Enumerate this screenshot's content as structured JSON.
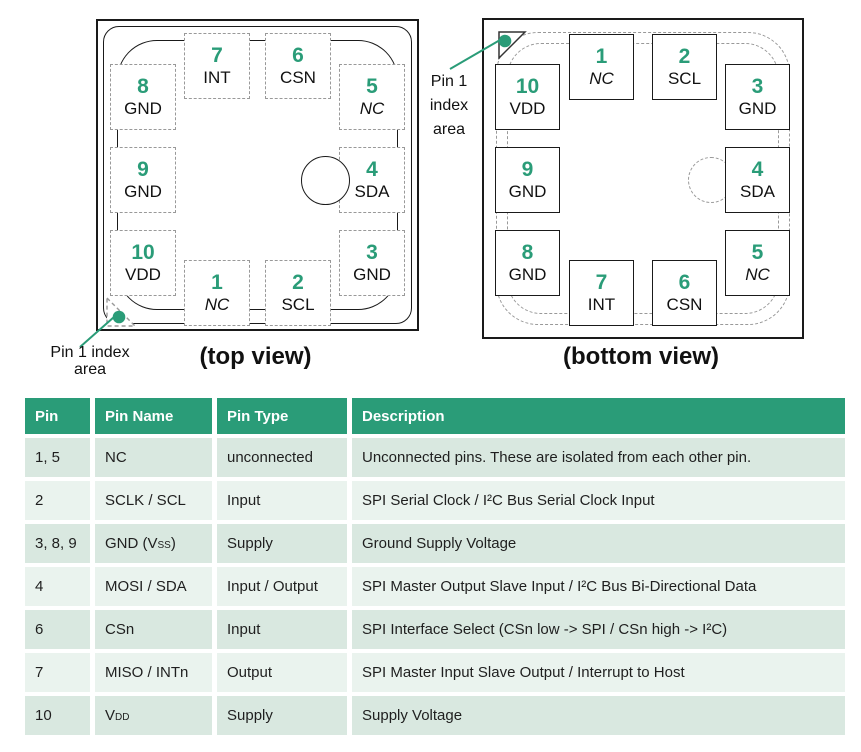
{
  "accent_green": "#2a9c78",
  "diagram": {
    "pins": [
      {
        "num": "1",
        "label": "NC"
      },
      {
        "num": "2",
        "label": "SCL"
      },
      {
        "num": "3",
        "label": "GND"
      },
      {
        "num": "4",
        "label": "SDA"
      },
      {
        "num": "5",
        "label": "NC"
      },
      {
        "num": "6",
        "label": "CSN"
      },
      {
        "num": "7",
        "label": "INT"
      },
      {
        "num": "8",
        "label": "GND"
      },
      {
        "num": "9",
        "label": "GND"
      },
      {
        "num": "10",
        "label": "VDD"
      }
    ],
    "top_view": {
      "caption": "(top view)",
      "index_lines": [
        "Pin 1 index",
        "area"
      ]
    },
    "bottom_view": {
      "caption": "(bottom view)",
      "index_lines": [
        "Pin 1",
        "index",
        "area"
      ]
    }
  },
  "table": {
    "header_bg": "#2a9c78",
    "row_color_dark": "#d9e8e0",
    "row_color_light": "#eaf3ee",
    "headers": [
      "Pin",
      "Pin Name",
      "Pin Type",
      "Description"
    ],
    "rows": [
      {
        "pin": "1, 5",
        "name": {
          "pre": "NC",
          "sub": "",
          "post": ""
        },
        "type": "unconnected",
        "desc": "Unconnected pins. These are isolated from each other pin."
      },
      {
        "pin": "2",
        "name": {
          "pre": "SCLK / SCL",
          "sub": "",
          "post": ""
        },
        "type": "Input",
        "desc": "SPI Serial Clock / I²C Bus Serial Clock Input"
      },
      {
        "pin": "3, 8, 9",
        "name": {
          "pre": "GND (V",
          "sub": "SS",
          "post": ")"
        },
        "type": "Supply",
        "desc": "Ground Supply Voltage"
      },
      {
        "pin": "4",
        "name": {
          "pre": "MOSI / SDA",
          "sub": "",
          "post": ""
        },
        "type": "Input / Output",
        "desc": "SPI Master Output Slave Input / I²C Bus Bi-Directional Data"
      },
      {
        "pin": "6",
        "name": {
          "pre": "CSn",
          "sub": "",
          "post": ""
        },
        "type": "Input",
        "desc": "SPI Interface Select (CSn low -> SPI / CSn high -> I²C)"
      },
      {
        "pin": "7",
        "name": {
          "pre": "MISO / INTn",
          "sub": "",
          "post": ""
        },
        "type": "Output",
        "desc": "SPI Master Input Slave Output / Interrupt to Host"
      },
      {
        "pin": "10",
        "name": {
          "pre": "V",
          "sub": "DD",
          "post": ""
        },
        "type": "Supply",
        "desc": "Supply Voltage"
      }
    ]
  }
}
